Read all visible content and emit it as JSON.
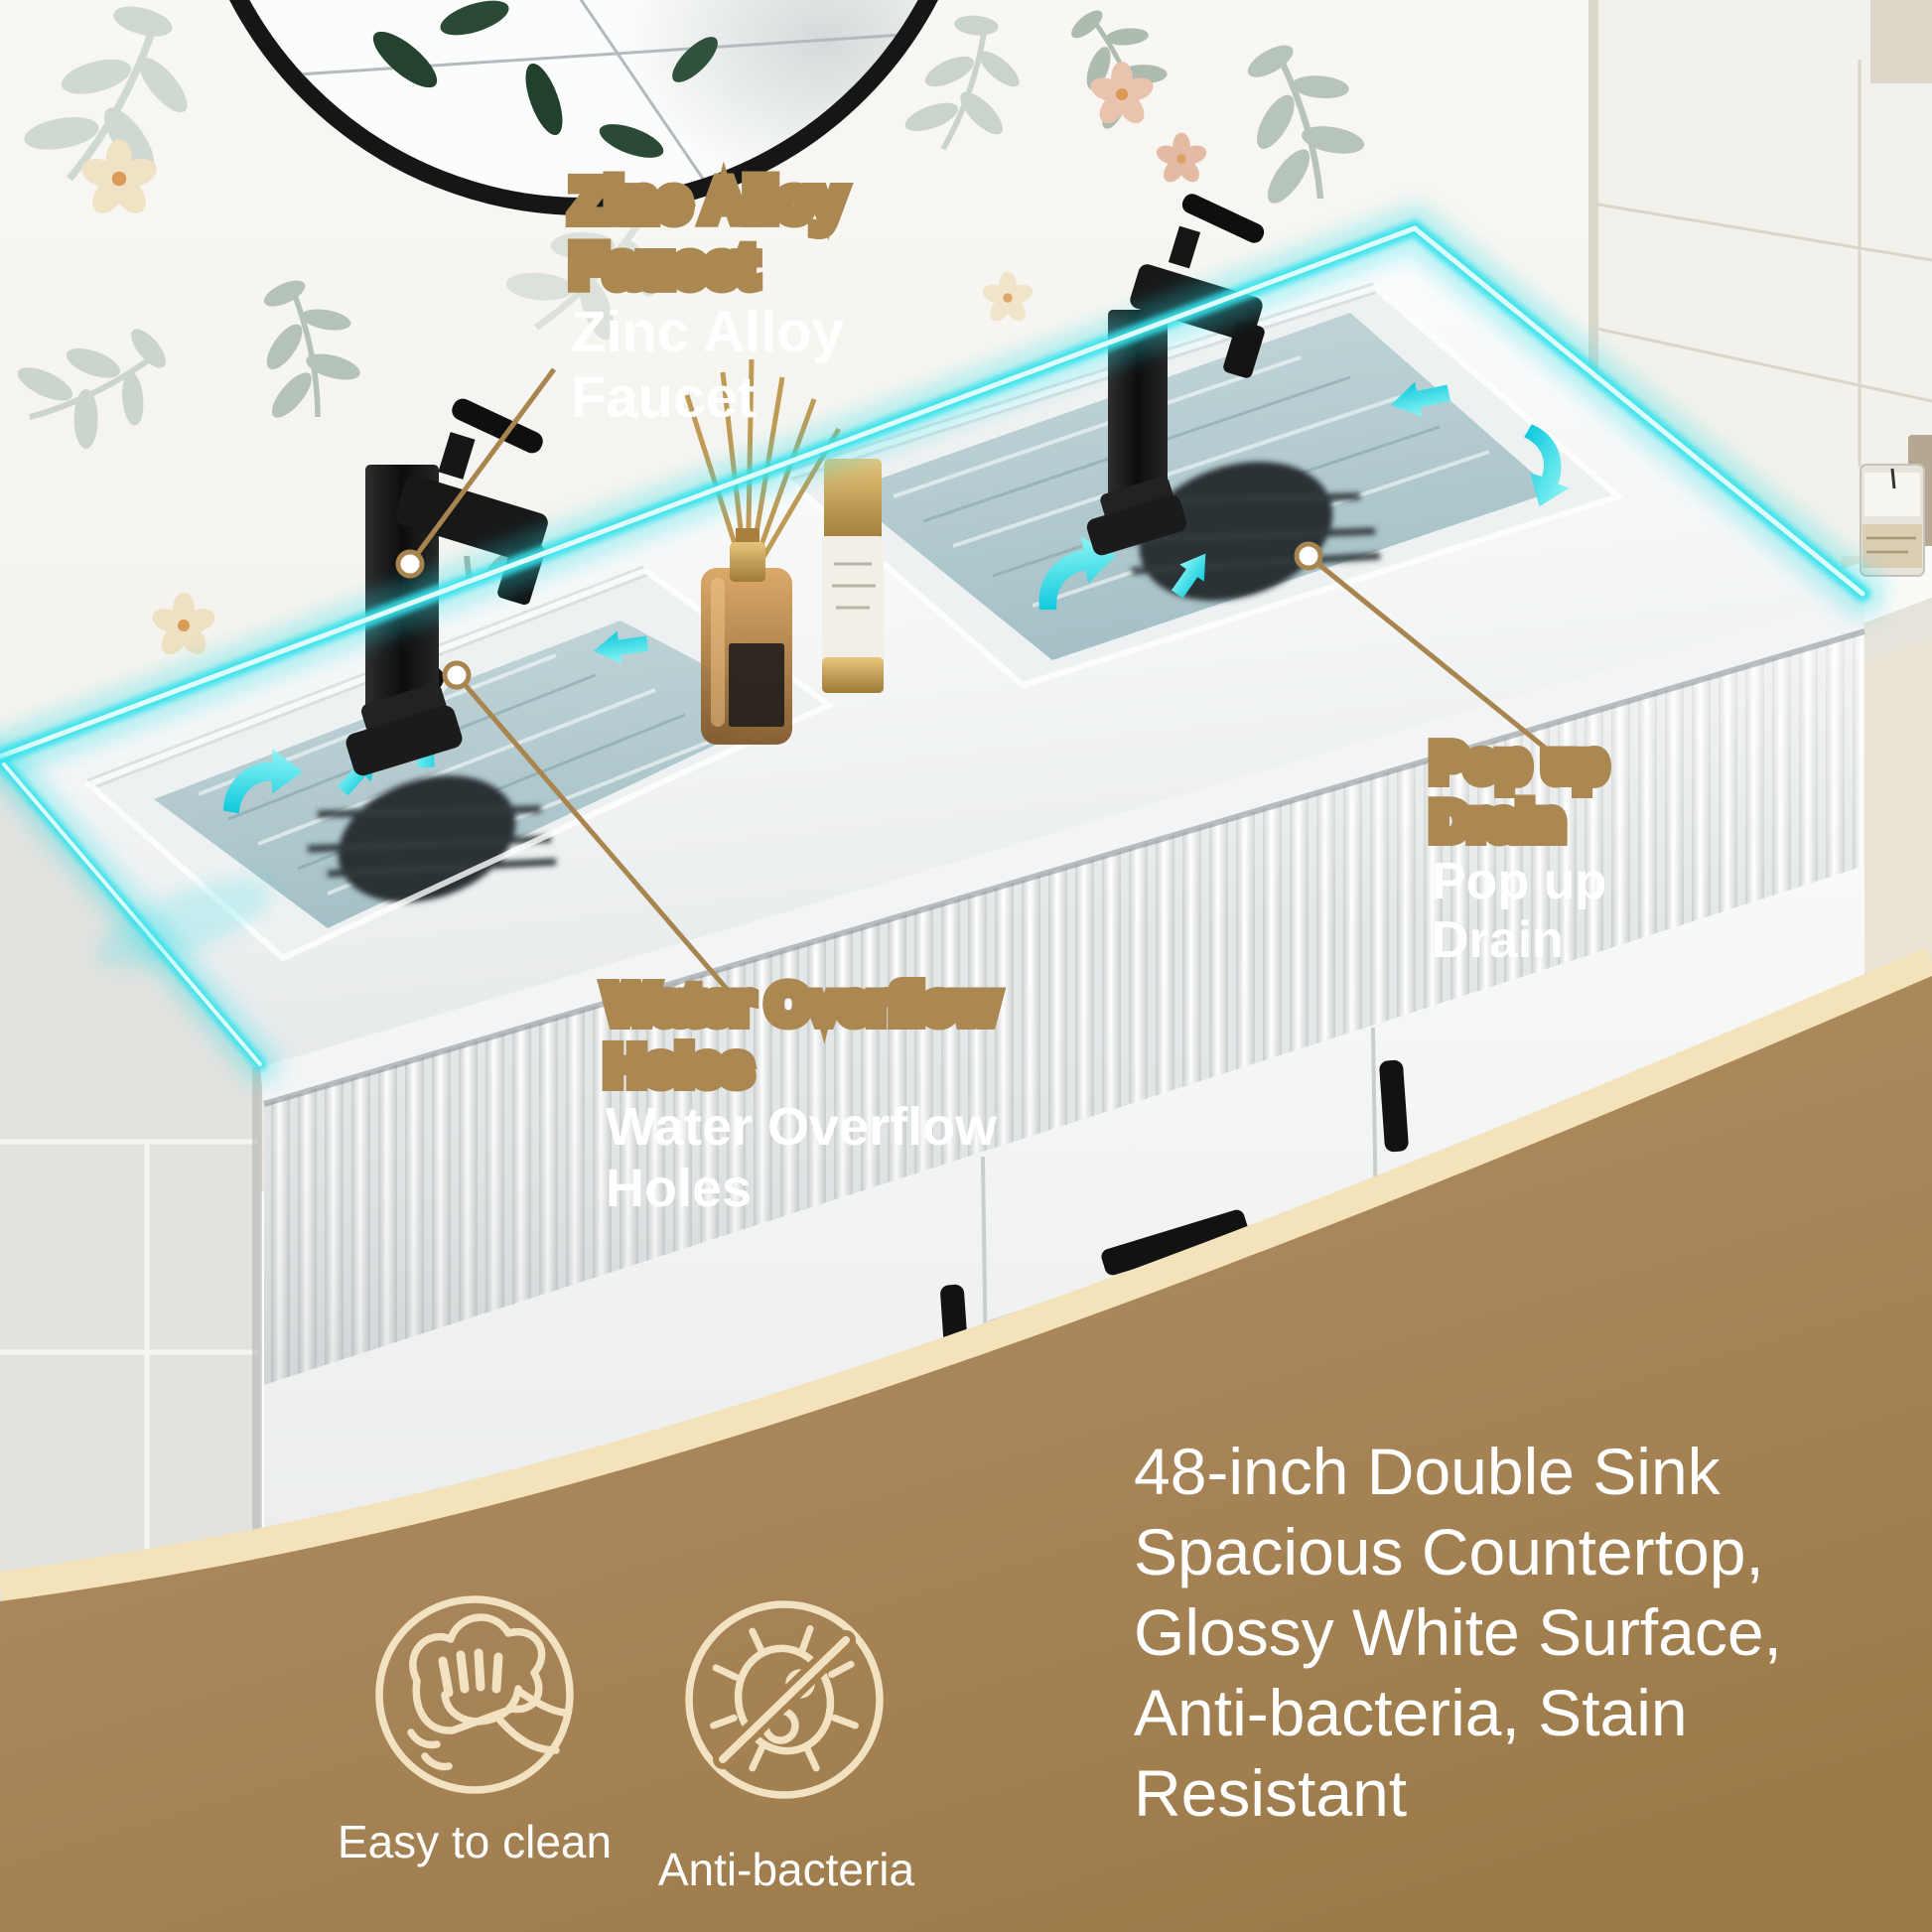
{
  "callouts": {
    "zinc_alloy_faucet": {
      "text": "Zinc Alloy\nFaucet"
    },
    "pop_up_drain": {
      "text": "Pop up\nDrain"
    },
    "water_overflow_holes": {
      "text": "Water Overflow\nHoles"
    }
  },
  "description": {
    "text": "48-inch Double Sink\nSpacious Countertop,\nGlossy White Surface,\nAnti-bacteria, Stain\nResistant"
  },
  "features": [
    {
      "label": "Easy to clean",
      "icon": "wipe-hand-icon"
    },
    {
      "label": "Anti-bacteria",
      "icon": "no-bacteria-icon"
    }
  ],
  "colors": {
    "accent_cyan": "#35e2ec",
    "callout_tan": "#ab8852",
    "overlay_brown": "#a8865a",
    "overlay_cream": "#f3e2ba",
    "text_white": "#ffffff"
  }
}
